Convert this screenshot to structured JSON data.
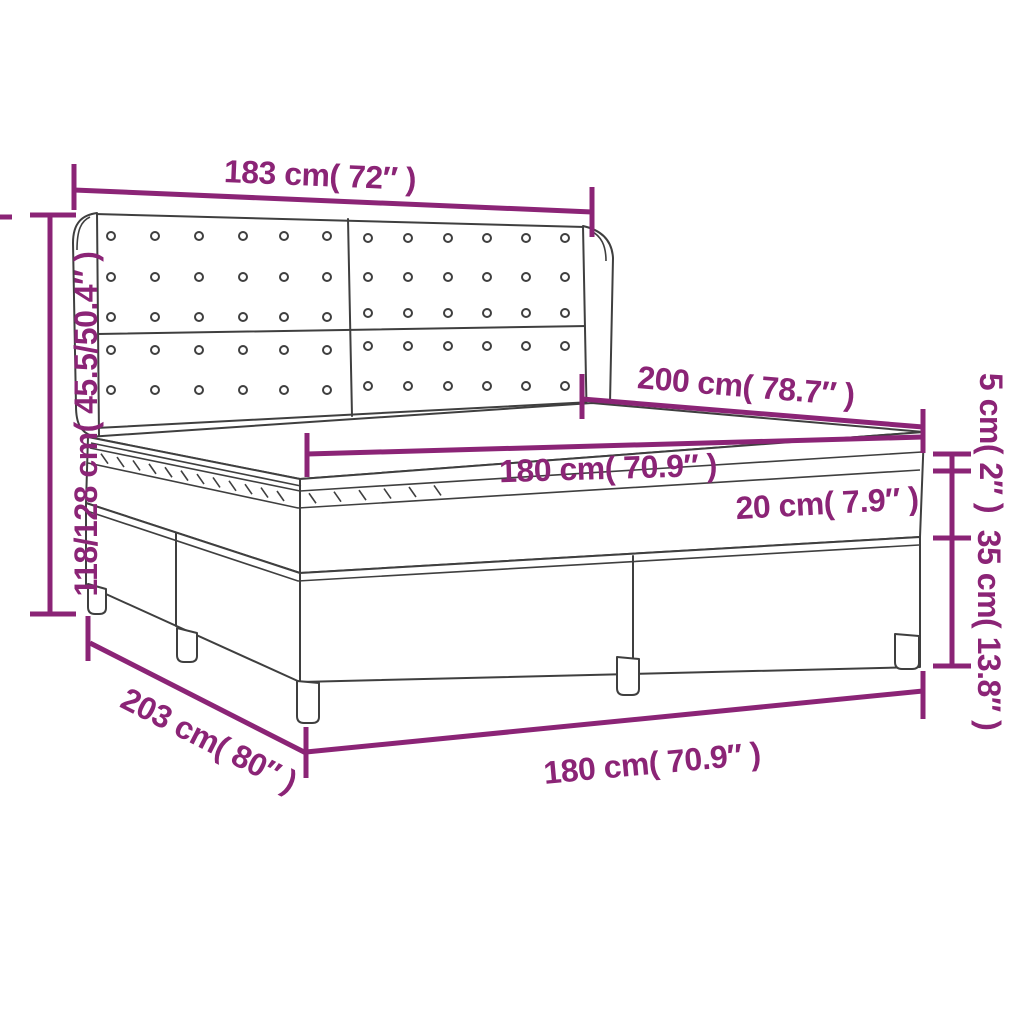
{
  "labels": {
    "headboard_width": "183 cm( 72″ )",
    "overall_height": "118/128 cm( 45.5/50.4″ )",
    "bed_length": "200 cm( 78.7″ )",
    "mattress_width": "180 cm( 70.9″ )",
    "mattress_height": "20 cm( 7.9″ )",
    "topper_height": "5 cm( 2″ )",
    "base_height": "35 cm( 13.8″ )",
    "base_length": "203 cm( 80″ )",
    "base_width": "180 cm( 70.9″ )"
  },
  "colors": {
    "dimension_lines": "#8B2476",
    "drawing_outline": "#3F3F3F",
    "background": "#FFFFFF"
  }
}
